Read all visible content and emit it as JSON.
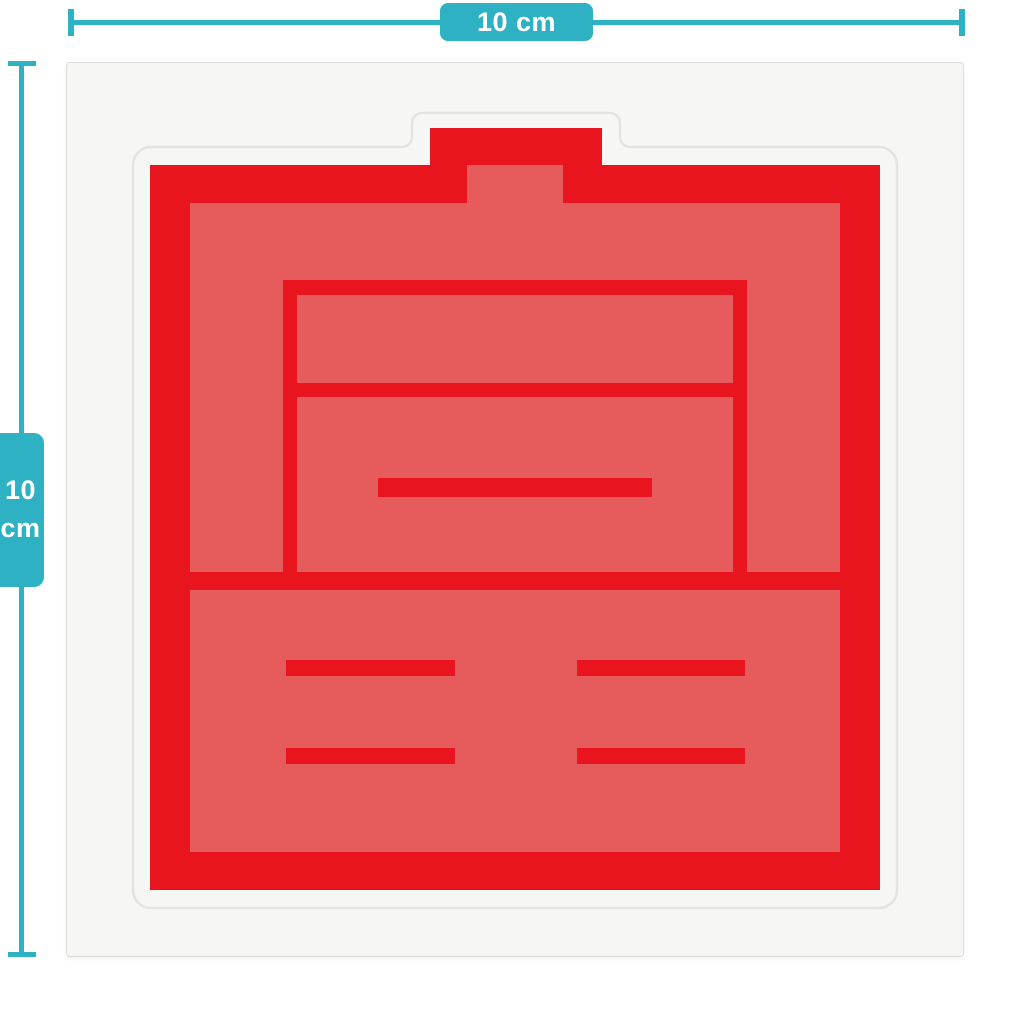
{
  "dimensions": {
    "width": {
      "label": "10 cm"
    },
    "height": {
      "value": "10",
      "unit": "cm"
    }
  },
  "sticker": {
    "description": "red pixel-block character decal",
    "icons": [
      "wealth-character-icon"
    ]
  },
  "colors": {
    "accent-teal": "#2eb2c3",
    "decal-red": "#e8151f",
    "decal-red-light": "#e65c5c",
    "page-bg": "#ffffff",
    "sticker-paper": "#f6f6f5",
    "sticker-border": "#dcdcdb",
    "die-cut-line": "#e3e3e1"
  }
}
